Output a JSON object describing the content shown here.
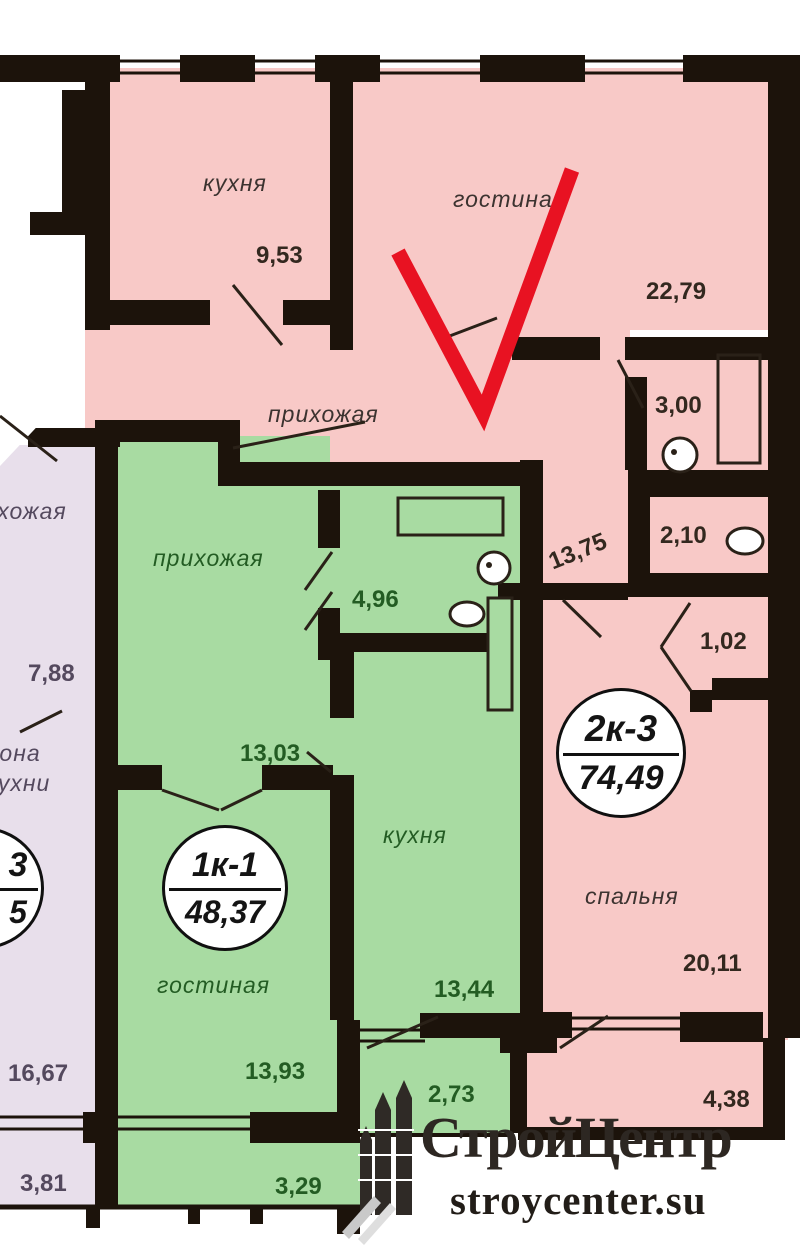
{
  "watermark": {
    "brand": "СтройЦентр",
    "site": "stroycenter.su"
  },
  "units": {
    "pink": {
      "name": "2к-3",
      "area": "74,49"
    },
    "green": {
      "name": "1к-1",
      "area": "48,37"
    },
    "purple": {
      "name_fragment": "3",
      "area_fragment": "5"
    }
  },
  "rooms": {
    "pink_kitchen": {
      "label": "кухня",
      "area": "9,53"
    },
    "pink_living": {
      "label": "гостиная",
      "area": "22,79"
    },
    "pink_hall": {
      "label": "прихожая",
      "area": "13,75"
    },
    "pink_bath": {
      "area": "3,00"
    },
    "pink_wc": {
      "area": "2,10"
    },
    "pink_storage": {
      "area": "1,02"
    },
    "pink_bedroom": {
      "label": "спальня",
      "area": "20,11"
    },
    "pink_balcony": {
      "area": "4,38"
    },
    "green_hall": {
      "label": "прихожая",
      "area": "13,03"
    },
    "green_bath": {
      "area": "4,96"
    },
    "green_kitchen": {
      "label": "кухня",
      "area": "13,44"
    },
    "green_living": {
      "label": "гостиная",
      "area": "13,93"
    },
    "green_balcony1": {
      "area": "2,73"
    },
    "green_balcony2": {
      "area": "3,29"
    },
    "purple_hall": {
      "label": "прихожая"
    },
    "purple_dim": {
      "area": "7,88"
    },
    "purple_zone": {
      "line1": "зона",
      "line2": "кухни"
    },
    "purple_room": {
      "area": "16,67"
    },
    "purple_balcony": {
      "area": "3,81"
    }
  },
  "colors": {
    "pink": "#f8c9c7",
    "green": "#a8dba2",
    "purple": "#e8dfeb",
    "wall": "#1c130b",
    "mark": "#e81222"
  }
}
